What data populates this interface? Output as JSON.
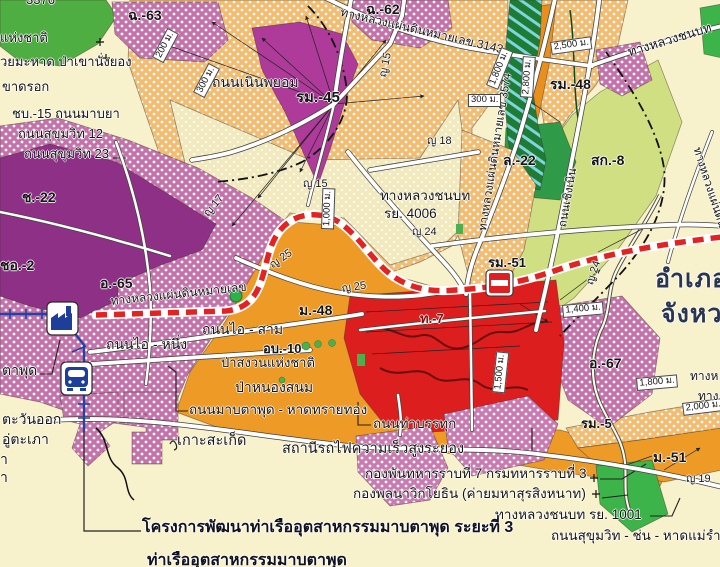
{
  "map": {
    "description_colors": {
      "background_cream": "#f7f1cc",
      "orange_dotted_zone": "#f2bd72",
      "orange_solid_zone": "#ee9a27",
      "purple_dotted_zone": "#c571ab",
      "purple_solid_zone": "#ae3a9a",
      "dark_purple_zone": "#8e3086",
      "red_zone": "#dd1e1e",
      "green_zone": "#4fae41",
      "dark_green_canal": "#1e7c35",
      "light_green_zone": "#cfdf82",
      "railway_blue": "#2342a8",
      "route_dashed_red": "#e32222",
      "road_white": "#ffffff"
    },
    "icons": [
      "factory-icon",
      "train-station-icon",
      "no-entry-icon",
      "island-icon",
      "green-dot-marker"
    ],
    "labels": [
      {
        "t": "3376",
        "x": 26,
        "y": -7,
        "s": 13,
        "k": "partial-label"
      },
      {
        "t": "แห่งชาติ",
        "x": 0,
        "y": 31,
        "s": 13,
        "k": "place-label"
      },
      {
        "t": "วยมะหาด ป่าเขานั่งยอง",
        "x": 0,
        "y": 55,
        "s": 13,
        "k": "place-label"
      },
      {
        "t": "ขาดรอก",
        "x": 2,
        "y": 80,
        "s": 13,
        "k": "place-label"
      },
      {
        "t": "ชบ.-15 ถนนมาบยา",
        "x": 12,
        "y": 107,
        "s": 13,
        "k": "road-label"
      },
      {
        "t": "ถนนสุขุมวิท 12",
        "x": 18,
        "y": 127,
        "s": 13,
        "k": "road-label"
      },
      {
        "t": "ถนนสุขุมวิท 23",
        "x": 24,
        "y": 147,
        "s": 13,
        "k": "road-label"
      },
      {
        "t": "ฉ.-63",
        "x": 128,
        "y": 8,
        "s": 14,
        "k": "zone-code-label"
      },
      {
        "t": "ฉ.-62",
        "x": 366,
        "y": 2,
        "s": 14,
        "k": "zone-code-label"
      },
      {
        "t": "ถนนเนินพยอม",
        "x": 212,
        "y": 75,
        "s": 14,
        "k": "road-label"
      },
      {
        "t": "รม.-45",
        "x": 296,
        "y": 90,
        "s": 15,
        "k": "zone-code-label"
      },
      {
        "t": "ญ 15",
        "x": 378,
        "y": 76,
        "s": 11,
        "r": -78,
        "k": "road-label"
      },
      {
        "t": "ญ 15",
        "x": 303,
        "y": 179,
        "s": 11,
        "k": "road-label"
      },
      {
        "t": "ญ 18",
        "x": 427,
        "y": 136,
        "s": 11,
        "k": "road-label"
      },
      {
        "t": "ทางหลวงแผ่นดินหมายเลข 3143",
        "x": 342,
        "y": 6,
        "s": 12,
        "r": 13,
        "k": "road-label"
      },
      {
        "t": "ทางหลวงชนบท",
        "x": 626,
        "y": 46,
        "s": 13,
        "r": -17,
        "k": "road-label"
      },
      {
        "t": "รม.-48",
        "x": 550,
        "y": 77,
        "s": 14,
        "k": "zone-code-label"
      },
      {
        "t": "ทางหลวงแผ่นดินหมายเลข 3574",
        "x": 477,
        "y": 230,
        "s": 11.5,
        "r": -81,
        "k": "road-label"
      },
      {
        "t": "2,500 ม.",
        "x": 550,
        "y": 42,
        "s": 9.5,
        "r": -8,
        "b": 1,
        "k": "distance-label"
      },
      {
        "t": "2,800 ม.",
        "x": 520,
        "y": 97,
        "s": 9.5,
        "r": -86,
        "b": 1,
        "k": "distance-label"
      },
      {
        "t": "1,800 ม.",
        "x": 486,
        "y": 85,
        "s": 9.5,
        "r": -68,
        "b": 1,
        "k": "distance-label"
      },
      {
        "t": "300 ม.",
        "x": 468,
        "y": 94,
        "s": 9.5,
        "b": 1,
        "k": "distance-label"
      },
      {
        "t": "200 ม.",
        "x": 152,
        "y": 57,
        "s": 9.5,
        "r": -62,
        "b": 1,
        "k": "distance-label"
      },
      {
        "t": "300 ม.",
        "x": 193,
        "y": 92,
        "s": 9.5,
        "r": -62,
        "b": 1,
        "k": "distance-label"
      },
      {
        "t": "ญ 17",
        "x": 202,
        "y": 212,
        "s": 11,
        "r": -50,
        "k": "road-label"
      },
      {
        "t": "ญ 25",
        "x": 268,
        "y": 262,
        "s": 11,
        "r": -35,
        "k": "road-label"
      },
      {
        "t": "ญ 25",
        "x": 341,
        "y": 284,
        "s": 11,
        "r": -8,
        "k": "road-label"
      },
      {
        "t": "ญ 24",
        "x": 412,
        "y": 227,
        "s": 11,
        "k": "road-label"
      },
      {
        "t": "ทางหลวงชนบท",
        "x": 380,
        "y": 189,
        "s": 13.5,
        "k": "road-label"
      },
      {
        "t": "รย. 4006",
        "x": 384,
        "y": 207,
        "s": 13.5,
        "k": "road-label"
      },
      {
        "t": "ญ 24",
        "x": 585,
        "y": 283,
        "s": 11,
        "r": -72,
        "k": "road-label"
      },
      {
        "t": "1,000 ม.",
        "x": 321,
        "y": 229,
        "s": 9.5,
        "r": -88,
        "b": 1,
        "k": "distance-label"
      },
      {
        "t": "ทางหลวงแผ่นดินหมายเลข",
        "x": 110,
        "y": 295,
        "s": 12,
        "r": -6,
        "k": "road-label"
      },
      {
        "t": "อ.-65",
        "x": 100,
        "y": 276,
        "s": 14,
        "k": "zone-code-label"
      },
      {
        "t": "ช.-22",
        "x": 22,
        "y": 190,
        "s": 14,
        "k": "zone-code-label"
      },
      {
        "t": "ชอ.-2",
        "x": 0,
        "y": 258,
        "s": 14,
        "k": "zone-code-label"
      },
      {
        "t": "ม.-48",
        "x": 299,
        "y": 303,
        "s": 14,
        "k": "zone-code-label"
      },
      {
        "t": "รม.-51",
        "x": 488,
        "y": 256,
        "s": 13,
        "k": "zone-code-label"
      },
      {
        "t": "ถนนไอ - สาม",
        "x": 202,
        "y": 322,
        "s": 14,
        "k": "road-label"
      },
      {
        "t": "ถนนไอ - หนึ่ง",
        "x": 106,
        "y": 337,
        "s": 14,
        "k": "road-label"
      },
      {
        "t": "ล.-22",
        "x": 503,
        "y": 153,
        "s": 14,
        "k": "zone-code-label"
      },
      {
        "t": "สก.-8",
        "x": 591,
        "y": 153,
        "s": 14,
        "k": "zone-code-label"
      },
      {
        "t": "ถนนเชิงเนิน",
        "x": 557,
        "y": 226,
        "s": 11.5,
        "r": -80,
        "k": "road-label"
      },
      {
        "t": "ท.-7",
        "x": 420,
        "y": 312,
        "s": 13,
        "c": "#7e1111",
        "k": "zone-code-label"
      },
      {
        "t": "อ.-67",
        "x": 589,
        "y": 356,
        "s": 14,
        "k": "zone-code-label"
      },
      {
        "t": "อำเภอ",
        "x": 655,
        "y": 266,
        "s": 25,
        "k": "admin-label"
      },
      {
        "t": "จังหว",
        "x": 661,
        "y": 301,
        "s": 25,
        "k": "admin-label"
      },
      {
        "t": "1,500 ม.",
        "x": 492,
        "y": 392,
        "s": 9.5,
        "r": -84,
        "b": 1,
        "k": "distance-label"
      },
      {
        "t": "1,400 ม.",
        "x": 562,
        "y": 305,
        "s": 9.5,
        "r": -5,
        "b": 1,
        "k": "distance-label"
      },
      {
        "t": "1,800 ม.",
        "x": 636,
        "y": 378,
        "s": 9.5,
        "r": -5,
        "b": 1,
        "k": "distance-label"
      },
      {
        "t": "2,000 ม.",
        "x": 682,
        "y": 403,
        "s": 9.5,
        "r": -7,
        "b": 1,
        "k": "distance-label"
      },
      {
        "t": "รม.-5",
        "x": 581,
        "y": 417,
        "s": 13,
        "k": "zone-code-label"
      },
      {
        "t": "ม.-51",
        "x": 653,
        "y": 450,
        "s": 14,
        "k": "zone-code-label"
      },
      {
        "t": "ญ 19",
        "x": 686,
        "y": 474,
        "s": 11,
        "k": "road-label"
      },
      {
        "t": "ทางหลวงแผ่นดิน",
        "x": 702,
        "y": 146,
        "s": 11.5,
        "r": 72,
        "k": "road-label"
      },
      {
        "t": "ทางห",
        "x": 690,
        "y": 370,
        "s": 12,
        "k": "partial-label"
      },
      {
        "t": "ทาง",
        "x": 698,
        "y": 390,
        "s": 12,
        "k": "partial-label"
      },
      {
        "t": "อบ.-10",
        "x": 263,
        "y": 342,
        "s": 13,
        "k": "zone-code-label"
      },
      {
        "t": "ป่าสงวนแห่งชาติ",
        "x": 221,
        "y": 356,
        "s": 13,
        "k": "place-label"
      },
      {
        "t": "ป่าหนองสนม",
        "x": 235,
        "y": 380,
        "s": 14,
        "k": "place-label"
      },
      {
        "t": "ถนนมาบตาพุด - หาดทรายทอง",
        "x": 189,
        "y": 403,
        "s": 13.5,
        "k": "road-label"
      },
      {
        "t": "ถนนท่าบรรทุก",
        "x": 373,
        "y": 417,
        "s": 13.5,
        "k": "road-label"
      },
      {
        "t": "เกาะสะเก็ด",
        "x": 177,
        "y": 434,
        "s": 14.5,
        "k": "place-label"
      },
      {
        "t": "สถานีรถไฟความเร็วสูงระยอง",
        "x": 282,
        "y": 442,
        "s": 14.5,
        "k": "place-label"
      },
      {
        "t": "กองพันทหารราบที่ 7 กรมทหารราบที่ 3",
        "x": 365,
        "y": 467,
        "s": 13.5,
        "k": "place-label"
      },
      {
        "t": "กองพลนาวิกโยธิน (ค่ายมหาสุรสิงหนาท)",
        "x": 353,
        "y": 487,
        "s": 13.5,
        "k": "place-label"
      },
      {
        "t": "ทางหลวงชนบท รย. 1001",
        "x": 495,
        "y": 508,
        "s": 13.5,
        "k": "road-label"
      },
      {
        "t": "ถนนสุขุมวิท - ช่น - หาดแม่รำพึง",
        "x": 551,
        "y": 529,
        "s": 13.5,
        "k": "road-label"
      },
      {
        "t": "โครงการพัฒนาท่าเรืออุตสาหกรรมมาบตาพุด ระยะที่ 3",
        "x": 142,
        "y": 519,
        "s": 16,
        "k": "note-label"
      },
      {
        "t": "ท่าเรืออุตสาหกรรมมาบตาพุด",
        "x": 147,
        "y": 552,
        "s": 16,
        "k": "note-label"
      },
      {
        "t": "ตาพุด",
        "x": 2,
        "y": 363,
        "s": 14,
        "k": "place-label"
      },
      {
        "t": "ตะวันออก",
        "x": 2,
        "y": 412,
        "s": 14,
        "k": "place-label"
      },
      {
        "t": "อู่ตะเภา",
        "x": 2,
        "y": 432,
        "s": 14,
        "k": "place-label"
      },
      {
        "t": "า",
        "x": 0,
        "y": 452,
        "s": 14,
        "k": "partial-label"
      },
      {
        "t": "า",
        "x": 0,
        "y": 470,
        "s": 14,
        "k": "partial-label"
      }
    ]
  }
}
